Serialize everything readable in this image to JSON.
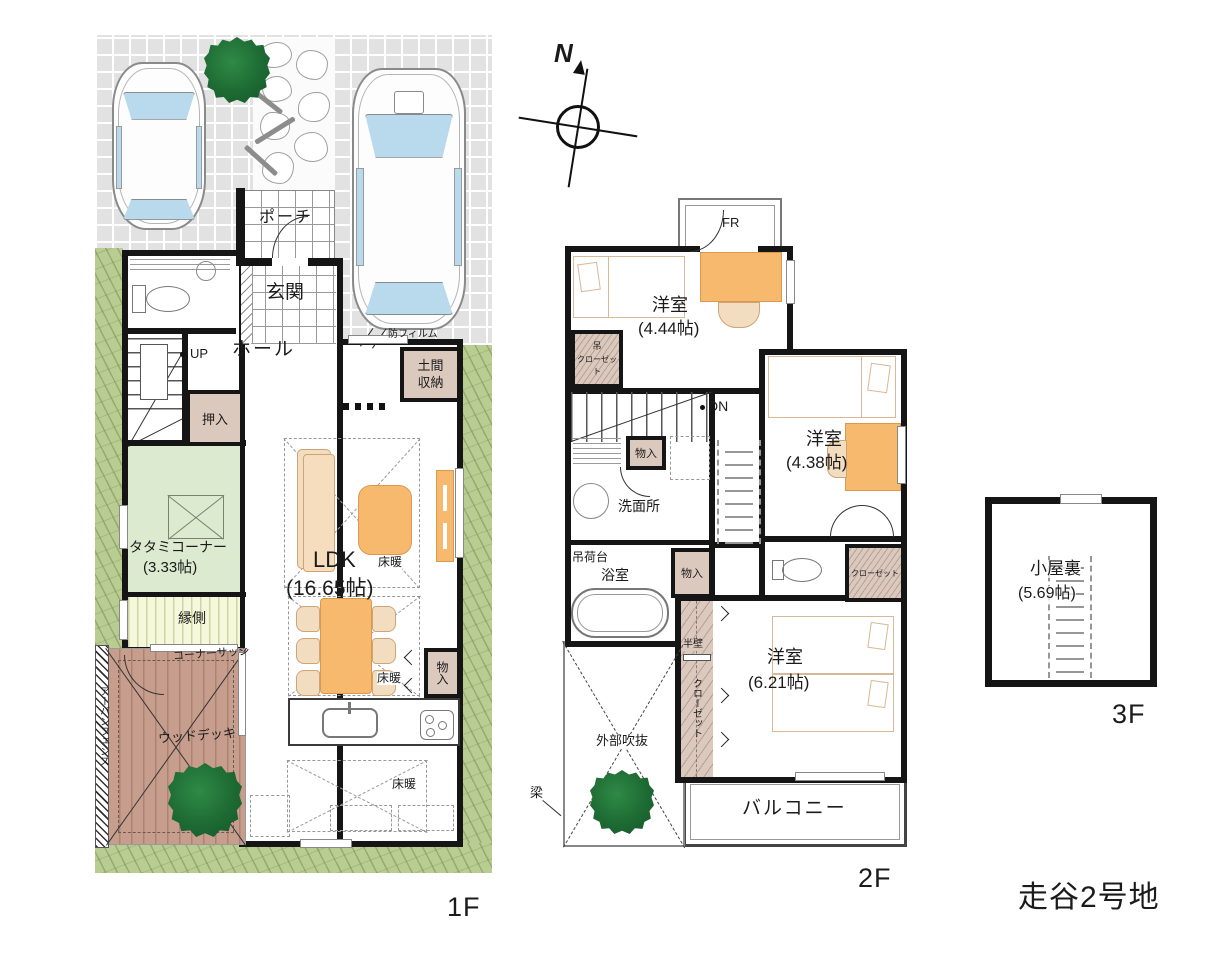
{
  "title": "走谷2号地",
  "compass": {
    "north": "N"
  },
  "f1": {
    "floor_label": "1F",
    "porch": "ポーチ",
    "genkan": "玄関",
    "hall": "ホール",
    "up": "UP",
    "oshiire": "押入",
    "film": "防フィルム",
    "doma_line1": "土間",
    "doma_line2": "収納",
    "tatami_name": "タタミコーナー",
    "tatami_size": "(3.33帖)",
    "engawa": "縁側",
    "ldk_name": "LDK",
    "ldk_size": "(16.65帖)",
    "yukadan": "床暖",
    "monoire": "物入",
    "corner_sash": "コーナーサッシ",
    "wood_deck": "ウッドデッキ",
    "urban_fence": "アーバンフェンス"
  },
  "f2": {
    "floor_label": "2F",
    "fr": "FR",
    "room444_name": "洋室",
    "room444_size": "(4.44帖)",
    "tsuri_line1": "吊",
    "tsuri_line2": "クローゼット",
    "dn": "DN",
    "monoire": "物入",
    "senmenjo": "洗面所",
    "tsurinidai": "吊荷台",
    "yokushitsu": "浴室",
    "room438_name": "洋室",
    "room438_size": "(4.38帖)",
    "closet": "クローゼット",
    "hankabe": "半壁",
    "closet_vert": "クローゼット",
    "fukinuke": "外部吹抜",
    "hari": "梁",
    "room621_name": "洋室",
    "room621_size": "(6.21帖)",
    "balcony": "バルコニー"
  },
  "f3": {
    "floor_label": "3F",
    "attic_name": "小屋裏",
    "attic_size": "(5.69帖)"
  }
}
